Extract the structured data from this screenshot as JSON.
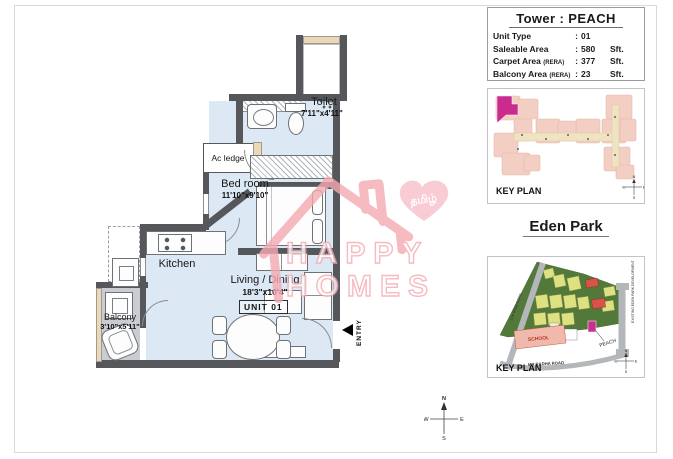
{
  "tower_info": {
    "title": "Tower : PEACH",
    "separator": ":",
    "rows": [
      {
        "label": "Unit Type",
        "sub": "",
        "value": "01",
        "unit": ""
      },
      {
        "label": "Saleable Area",
        "sub": "",
        "value": "580",
        "unit": "Sft."
      },
      {
        "label": "Carpet Area",
        "sub": "(RERA)",
        "value": "377",
        "unit": "Sft."
      },
      {
        "label": "Balcony Area",
        "sub": "(RERA)",
        "value": "23",
        "unit": "Sft."
      }
    ]
  },
  "floor_plan": {
    "rooms": {
      "toilet": {
        "name": "Toilet",
        "dims": "7'11\"x4'11\""
      },
      "ac_ledge": {
        "name": "Ac ledge"
      },
      "bedroom": {
        "name": "Bed room",
        "dims": "11'10\"x9'10\""
      },
      "kitchen": {
        "name": "Kitchen"
      },
      "living": {
        "name": "Living / Dining",
        "dims": "18'3\"x10'4\""
      },
      "balcony": {
        "name": "Balcony",
        "dims": "3'10\"x5'11\""
      }
    },
    "unit_label": "UNIT 01",
    "entry_label": "ENTRY"
  },
  "watermark": {
    "line1": "HAPPY",
    "line2": "HOMES",
    "heart_text": "தமிழ்"
  },
  "key_plan": {
    "label": "KEY PLAN"
  },
  "eden_park": {
    "title": "Eden Park",
    "school_label": "SCHOOL",
    "peach_label": "PEACH",
    "road_left_label": "12M WIDE ROAD",
    "road_bottom_label": "MR RADHA ROAD",
    "right_note": "EXISTING EDEN PARK DEVELOPMENT",
    "key_plan_label": "KEY PLAN"
  },
  "compass": {
    "n": "N",
    "s": "S",
    "e": "E",
    "w": "W"
  }
}
